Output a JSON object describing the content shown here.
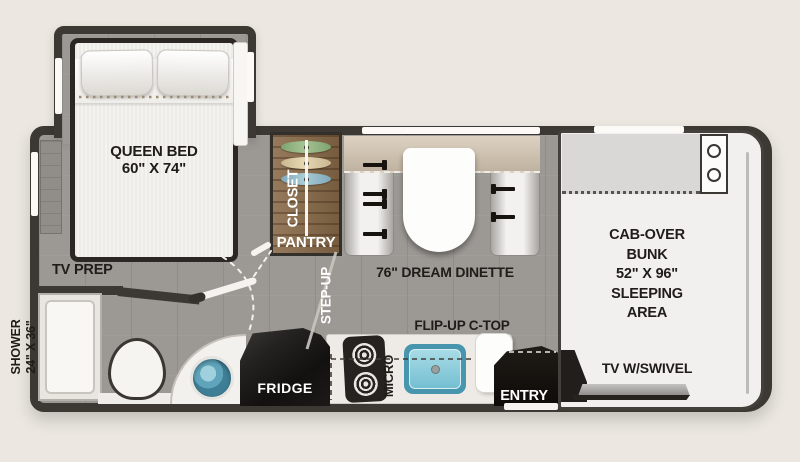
{
  "plan": {
    "bedroom": {
      "bed_line1": "QUEEN BED",
      "bed_line2": "60\" X 74\"",
      "tv_prep": "TV PREP"
    },
    "bathroom": {
      "shower_line1": "SHOWER",
      "shower_line2": "24\" X 36\""
    },
    "storage": {
      "closet": "CLOSET",
      "pantry": "PANTRY"
    },
    "living": {
      "step_up": "STEP-UP",
      "dinette": "76\" DREAM DINETTE"
    },
    "kitchen": {
      "fridge": "FRIDGE",
      "micro": "MICRO",
      "flip_up": "FLIP-UP C-TOP",
      "entry": "ENTRY"
    },
    "cab": {
      "line1": "CAB-OVER",
      "line2": "BUNK",
      "line3": "52\" X 96\"",
      "line4": "SLEEPING",
      "line5": "AREA",
      "tv": "TV W/SWIVEL"
    }
  },
  "colors": {
    "background": "#ece8e1",
    "wall": "#3c3833",
    "floor": "#9c9995",
    "wood_cabinet": "#8a6b49",
    "sink_teal": "#74bfd2",
    "hanger_green": "#8fae7e",
    "hanger_tan": "#d6c6a1",
    "hanger_blue": "#8fb8c6",
    "counter_white": "#eeebe7",
    "appliance_black": "#1b1815"
  }
}
